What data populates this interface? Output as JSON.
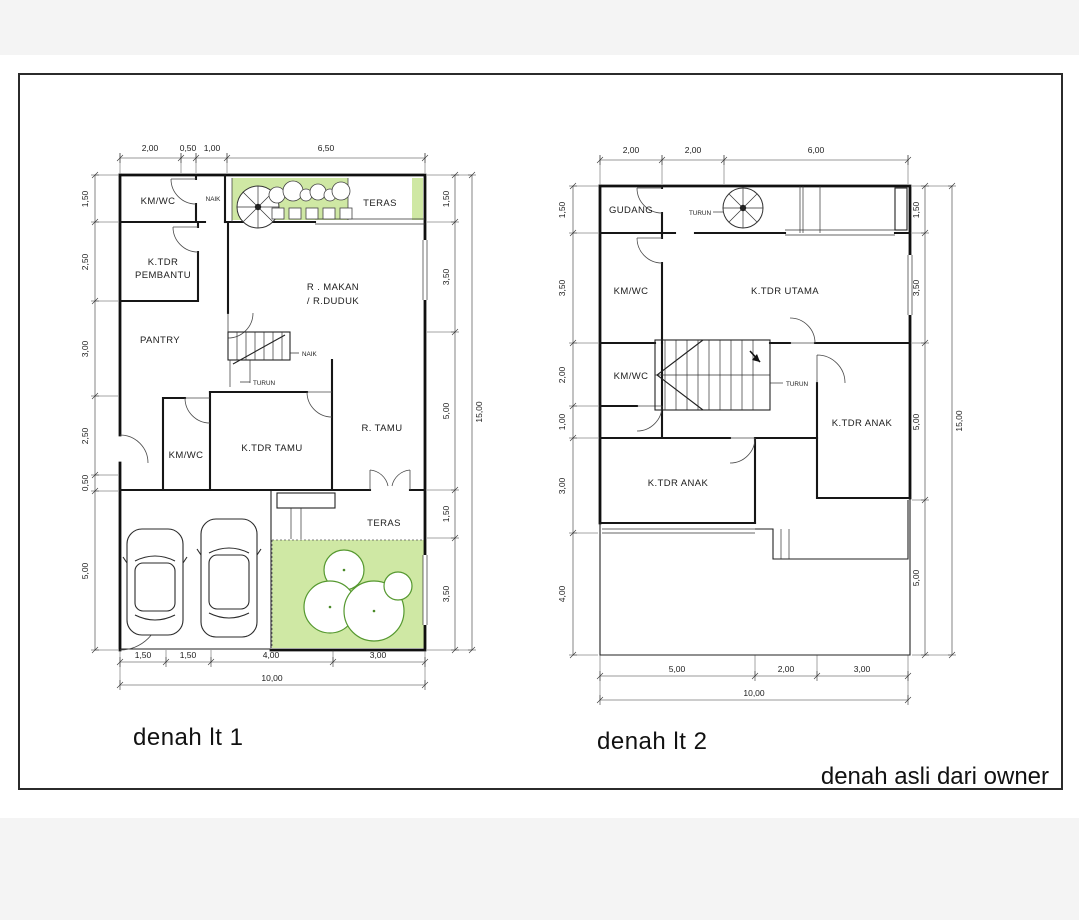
{
  "note": "denah asli dari owner",
  "colors": {
    "lawn_green": "#cfe8a4",
    "tree_green": "#55982f",
    "line": "#1a1a1a"
  },
  "plan1": {
    "title": "denah lt 1",
    "rooms": {
      "kmwc_top": "KM/WC",
      "ktdr_pembantu_1": "K.TDR",
      "ktdr_pembantu_2": "PEMBANTU",
      "pantry": "PANTRY",
      "r_makan_1": "R . MAKAN",
      "r_makan_2": "/ R.DUDUK",
      "teras_top": "TERAS",
      "kmwc_low": "KM/WC",
      "ktdr_tamu": "K.TDR TAMU",
      "r_tamu": "R. TAMU",
      "teras_low": "TERAS"
    },
    "stairs": {
      "naik_top": "NAIK",
      "naik_mid": "NAIK",
      "turun_mid": "TURUN"
    },
    "dims": {
      "top": [
        "2,00",
        "0,50",
        "1,00",
        "6,50"
      ],
      "left": [
        "1,50",
        "2,50",
        "3,00",
        "2,50",
        "0,50",
        "5,00"
      ],
      "right": [
        "1,50",
        "3,50",
        "5,00",
        "1,50",
        "3,50"
      ],
      "right_total": "15,00",
      "bottom": [
        "1,50",
        "1,50",
        "4,00",
        "3,00"
      ],
      "bottom_total": "10,00"
    }
  },
  "plan2": {
    "title": "denah lt 2",
    "rooms": {
      "gudang": "GUDANG",
      "kmwc_up": "KM/WC",
      "ktdr_utama": "K.TDR UTAMA",
      "kmwc_low": "KM/WC",
      "ktdr_anak_right": "K.TDR ANAK",
      "ktdr_anak_left": "K.TDR ANAK"
    },
    "stairs": {
      "turun_top": "TURUN",
      "turun_mid": "TURUN"
    },
    "dims": {
      "top": [
        "2,00",
        "2,00",
        "6,00"
      ],
      "left": [
        "1,50",
        "3,50",
        "2,00",
        "1,00",
        "3,00",
        "4,00"
      ],
      "right": [
        "1,50",
        "3,50",
        "5,00",
        "5,00"
      ],
      "right_total": "15,00",
      "bottom": [
        "5,00",
        "2,00",
        "3,00"
      ],
      "bottom_total": "10,00"
    }
  }
}
